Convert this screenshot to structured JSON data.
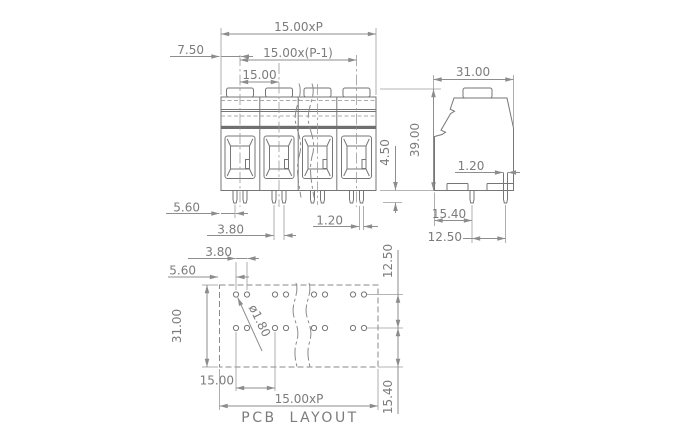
{
  "canvas": {
    "background": "#ffffff",
    "line_color": "#767676",
    "dimension_color": "#8c8c8c",
    "text_color": "#7c7c7c"
  },
  "front_view": {
    "dim_pitch_total": "15.00xP",
    "dim_pitch_span": "15.00x(P-1)",
    "dim_pitch": "15.00",
    "dim_half_pitch": "7.50",
    "dim_edge_to_pin": "5.60",
    "dim_pin_pair_spacing": "3.80",
    "dim_pin_width": "1.20",
    "dim_pin_length": "4.50",
    "dim_height": "39.00"
  },
  "side_view": {
    "dim_width": "31.00",
    "dim_pin_width": "1.20",
    "dim_edge_to_pin_row": "15.40",
    "dim_pin_row_spacing": "12.50"
  },
  "pcb_layout": {
    "dim_hole_pair_spacing": "3.80",
    "dim_edge_to_hole": "5.60",
    "dim_board_width": "31.00",
    "dim_hole_diameter": "ø1.80",
    "dim_pitch": "15.00",
    "dim_pitch_total": "15.00xP",
    "dim_row_spacing": "12.50",
    "dim_row_to_edge": "15.40",
    "caption": "PCB LAYOUT"
  }
}
